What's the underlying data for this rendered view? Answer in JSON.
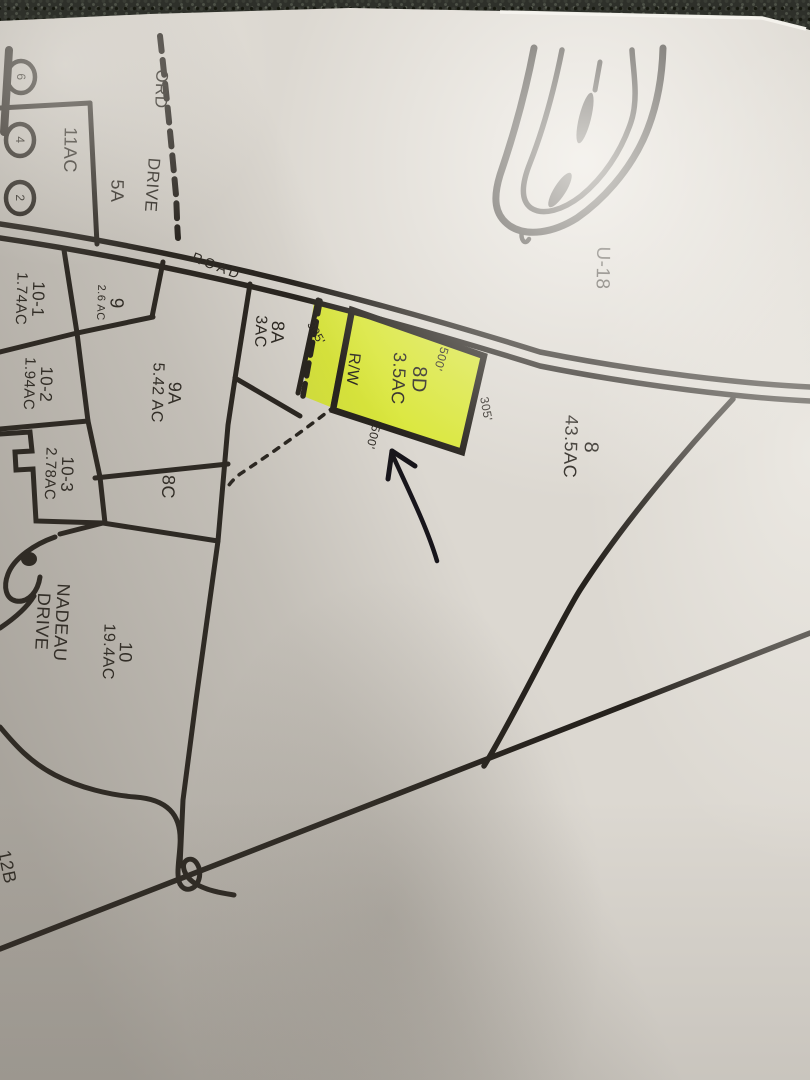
{
  "scene": {
    "description": "Photograph of a paper municipal tax map lying on dark carpet; parcel 8D is highlighted in yellow-green with a hand-drawn ink arrow pointing at it",
    "surface": "carpet",
    "paper_color": "#dcd8d1",
    "ink_color": "#26221d",
    "highlight_color": "#d9e833"
  },
  "map": {
    "zone_label": "U-18",
    "road_label": "ROAD",
    "top_drive": {
      "name_partial": "ORD",
      "name_suffix": "DRIVE"
    },
    "nadeau_drive": {
      "line1": "NADEAU",
      "line2": "DRIVE"
    },
    "right_of_way_label": "R/W",
    "highlighted_parcel": {
      "id": "8D",
      "acreage": "3.5AC"
    },
    "parcels": [
      {
        "id": "8D",
        "acreage": "3.5AC",
        "highlighted": true
      },
      {
        "id": "8",
        "acreage": "43.5AC"
      },
      {
        "id": "8A",
        "acreage": "3AC"
      },
      {
        "id": "8C",
        "acreage": ""
      },
      {
        "id": "9",
        "acreage": "2.6 AC"
      },
      {
        "id": "9A",
        "acreage": "5.42 AC"
      },
      {
        "id": "10",
        "acreage": "19.4AC"
      },
      {
        "id": "10-1",
        "acreage": "1.74AC"
      },
      {
        "id": "10-2",
        "acreage": "1.94AC"
      },
      {
        "id": "10-3",
        "acreage": "2.78AC"
      },
      {
        "id": "",
        "acreage": "11AC"
      },
      {
        "id": "5A",
        "acreage": ""
      },
      {
        "id": "12B",
        "acreage": ""
      }
    ],
    "measurements": {
      "top_frontage": "500'",
      "se_side": "305'",
      "bottom_side": "500'",
      "rw_side": "305'"
    },
    "lot_circle_numbers": [
      "6",
      "4",
      "2"
    ]
  }
}
